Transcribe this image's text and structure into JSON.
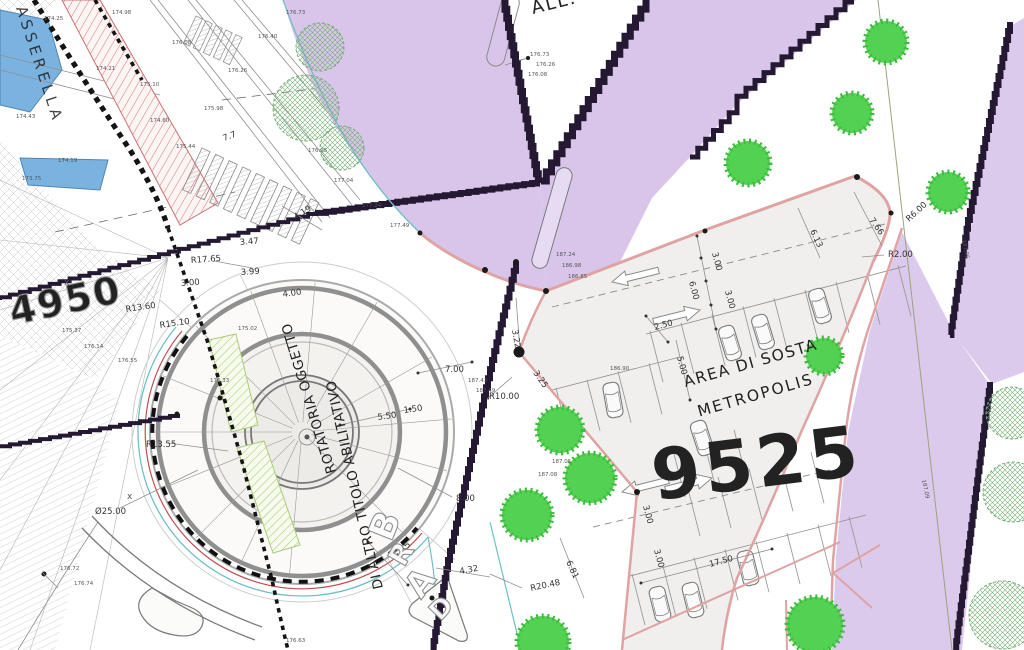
{
  "drawing": {
    "annotations": {
      "waterway_label": "ASSERELLA",
      "top_label": "ALL.",
      "rotatoria_line1": "ROTATORIA OGGETTO",
      "rotatoria_line2": "DI ALTRO TITOLO ABILITATIVO",
      "area_sosta_line1": "AREA DI SOSTA",
      "area_sosta_line2": "METROPOLIS",
      "parcel_number_large": "9525",
      "parcel_number_left": "4950",
      "curve_letters": [
        "B",
        "R",
        "A",
        "D"
      ],
      "x_marker": "x"
    },
    "dimension_labels": [
      {
        "t": "R17.65",
        "x": 191,
        "y": 263,
        "r": -4
      },
      {
        "t": "3.00",
        "x": 181,
        "y": 286,
        "r": -4
      },
      {
        "t": "3.47",
        "x": 240,
        "y": 245,
        "r": -5
      },
      {
        "t": "3.99",
        "x": 241,
        "y": 275,
        "r": -4
      },
      {
        "t": "4.00",
        "x": 283,
        "y": 297,
        "r": -8
      },
      {
        "t": "R13.60",
        "x": 126,
        "y": 312,
        "r": -8
      },
      {
        "t": "R15.10",
        "x": 160,
        "y": 328,
        "r": -8
      },
      {
        "t": "R13.55",
        "x": 146,
        "y": 447,
        "r": 0
      },
      {
        "t": "Ø25.00",
        "x": 95,
        "y": 514,
        "r": 0
      },
      {
        "t": "4.19",
        "x": 296,
        "y": 220,
        "r": -33
      },
      {
        "t": "7.7",
        "x": 224,
        "y": 141,
        "r": -20
      },
      {
        "t": "5.50",
        "x": 378,
        "y": 420,
        "r": -8
      },
      {
        "t": "1.50",
        "x": 404,
        "y": 413,
        "r": -8
      },
      {
        "t": "7.00",
        "x": 445,
        "y": 372,
        "r": 0
      },
      {
        "t": "3.22",
        "x": 512,
        "y": 330,
        "r": 80
      },
      {
        "t": "3.25",
        "x": 533,
        "y": 373,
        "r": 55
      },
      {
        "t": "R10.00",
        "x": 489,
        "y": 399,
        "r": 0
      },
      {
        "t": "8.00",
        "x": 456,
        "y": 501,
        "r": 0
      },
      {
        "t": "4.45",
        "x": 400,
        "y": 560,
        "r": -55
      },
      {
        "t": "4.32",
        "x": 460,
        "y": 574,
        "r": -10
      },
      {
        "t": "R20.48",
        "x": 531,
        "y": 591,
        "r": -12
      },
      {
        "t": "6.81",
        "x": 566,
        "y": 562,
        "r": 65
      },
      {
        "t": "2.50",
        "x": 655,
        "y": 330,
        "r": -15
      },
      {
        "t": "6.00",
        "x": 689,
        "y": 282,
        "r": 75
      },
      {
        "t": "3.00",
        "x": 712,
        "y": 253,
        "r": 75
      },
      {
        "t": "3.00",
        "x": 725,
        "y": 291,
        "r": 75
      },
      {
        "t": "5.00",
        "x": 677,
        "y": 357,
        "r": 75
      },
      {
        "t": "3.00",
        "x": 643,
        "y": 506,
        "r": 75
      },
      {
        "t": "3.00",
        "x": 654,
        "y": 550,
        "r": 75
      },
      {
        "t": "17.50",
        "x": 710,
        "y": 567,
        "r": -15
      },
      {
        "t": "R2.00",
        "x": 888,
        "y": 257,
        "r": 0
      },
      {
        "t": "R6.00",
        "x": 909,
        "y": 222,
        "r": -42
      },
      {
        "t": "7.66",
        "x": 869,
        "y": 220,
        "r": 55
      },
      {
        "t": "6.13",
        "x": 810,
        "y": 231,
        "r": 65
      }
    ],
    "spot_elevations": [
      {
        "t": "174.25",
        "x": 44,
        "y": 20
      },
      {
        "t": "174.98",
        "x": 112,
        "y": 14
      },
      {
        "t": "175.10",
        "x": 140,
        "y": 86
      },
      {
        "t": "174.21",
        "x": 96,
        "y": 70
      },
      {
        "t": "174.43",
        "x": 16,
        "y": 118
      },
      {
        "t": "176.08",
        "x": 172,
        "y": 44
      },
      {
        "t": "174.60",
        "x": 150,
        "y": 122
      },
      {
        "t": "174.19",
        "x": 58,
        "y": 162
      },
      {
        "t": "173.75",
        "x": 22,
        "y": 180
      },
      {
        "t": "175.44",
        "x": 176,
        "y": 148
      },
      {
        "t": "175.98",
        "x": 204,
        "y": 110
      },
      {
        "t": "176.26",
        "x": 228,
        "y": 72
      },
      {
        "t": "176.40",
        "x": 258,
        "y": 38
      },
      {
        "t": "176.73",
        "x": 286,
        "y": 14
      },
      {
        "t": "176.95",
        "x": 308,
        "y": 152
      },
      {
        "t": "177.04",
        "x": 334,
        "y": 182
      },
      {
        "t": "177.24",
        "x": 362,
        "y": 207
      },
      {
        "t": "177.49",
        "x": 390,
        "y": 227
      },
      {
        "t": "176.73",
        "x": 530,
        "y": 56
      },
      {
        "t": "176.26",
        "x": 536,
        "y": 66
      },
      {
        "t": "176.08",
        "x": 528,
        "y": 76
      },
      {
        "t": "187.24",
        "x": 556,
        "y": 256
      },
      {
        "t": "186.98",
        "x": 562,
        "y": 267
      },
      {
        "t": "186.85",
        "x": 568,
        "y": 278
      },
      {
        "t": "187.43",
        "x": 468,
        "y": 382
      },
      {
        "t": "187.49",
        "x": 476,
        "y": 392
      },
      {
        "t": "187.06",
        "x": 962,
        "y": 240,
        "r": 78
      },
      {
        "t": "187.09",
        "x": 922,
        "y": 480,
        "r": 78
      },
      {
        "t": "175.37",
        "x": 62,
        "y": 332
      },
      {
        "t": "176.14",
        "x": 84,
        "y": 348
      },
      {
        "t": "176.55",
        "x": 118,
        "y": 362
      },
      {
        "t": "176.72",
        "x": 60,
        "y": 570
      },
      {
        "t": "176.74",
        "x": 74,
        "y": 585
      },
      {
        "t": "176.63",
        "x": 286,
        "y": 642
      },
      {
        "t": "187.08",
        "x": 538,
        "y": 476
      },
      {
        "t": "187.05",
        "x": 552,
        "y": 463
      },
      {
        "t": "186.90",
        "x": 610,
        "y": 370
      },
      {
        "t": "175.02",
        "x": 238,
        "y": 330
      },
      {
        "t": "176.33",
        "x": 210,
        "y": 382
      }
    ],
    "colors": {
      "water": "#7ab3e0",
      "road_purple": "#d9c5ea",
      "road_purple_dark": "#241832",
      "curb_pink": "#dfa3a3",
      "tree_green": "#52d152",
      "parking_fill": "#f0efed",
      "accent_red": "#c05050",
      "accent_teal": "#6fbfc4",
      "hatch_red": "#d88080",
      "line_gray": "#8a8a8a",
      "text_dark": "#1c1c1c"
    }
  }
}
